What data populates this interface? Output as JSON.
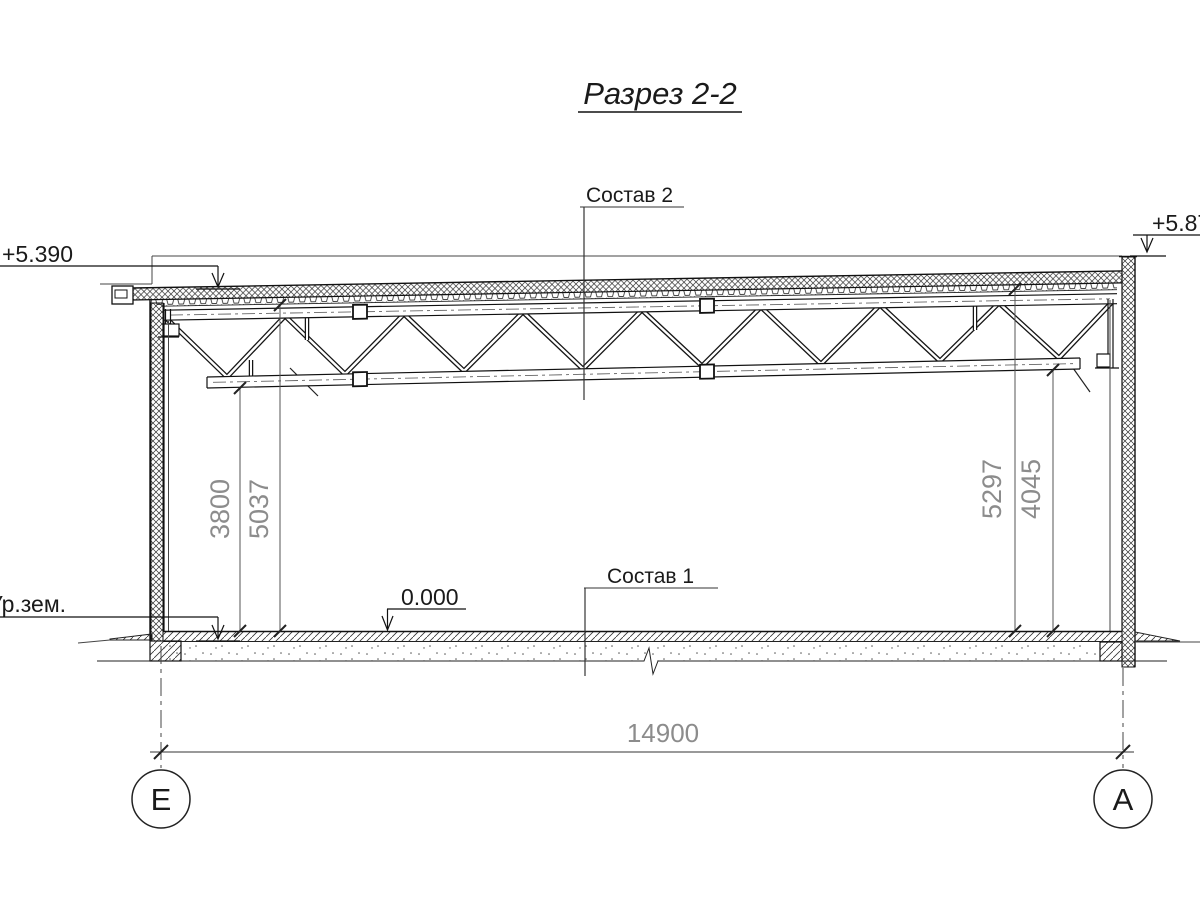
{
  "drawing": {
    "title": "Разрез 2-2"
  },
  "labels": {
    "roof_composition": "Состав 2",
    "floor_composition": "Состав 1"
  },
  "levels": {
    "roof_left": "+5.390",
    "parapet_right": "+5.870",
    "floor": "0.000",
    "ground": "Ур.зем."
  },
  "dimensions": {
    "span": "14900",
    "left_to_bottom_chord": "3800",
    "left_to_roof_deck": "5037",
    "right_to_roof_deck": "5297",
    "right_to_bottom_chord": "4045"
  },
  "axes": {
    "left_label": "Е",
    "right_label": "А"
  },
  "colors": {
    "line": "#1a1a1a",
    "dim_text": "#8c8c8c",
    "background": "#ffffff"
  }
}
